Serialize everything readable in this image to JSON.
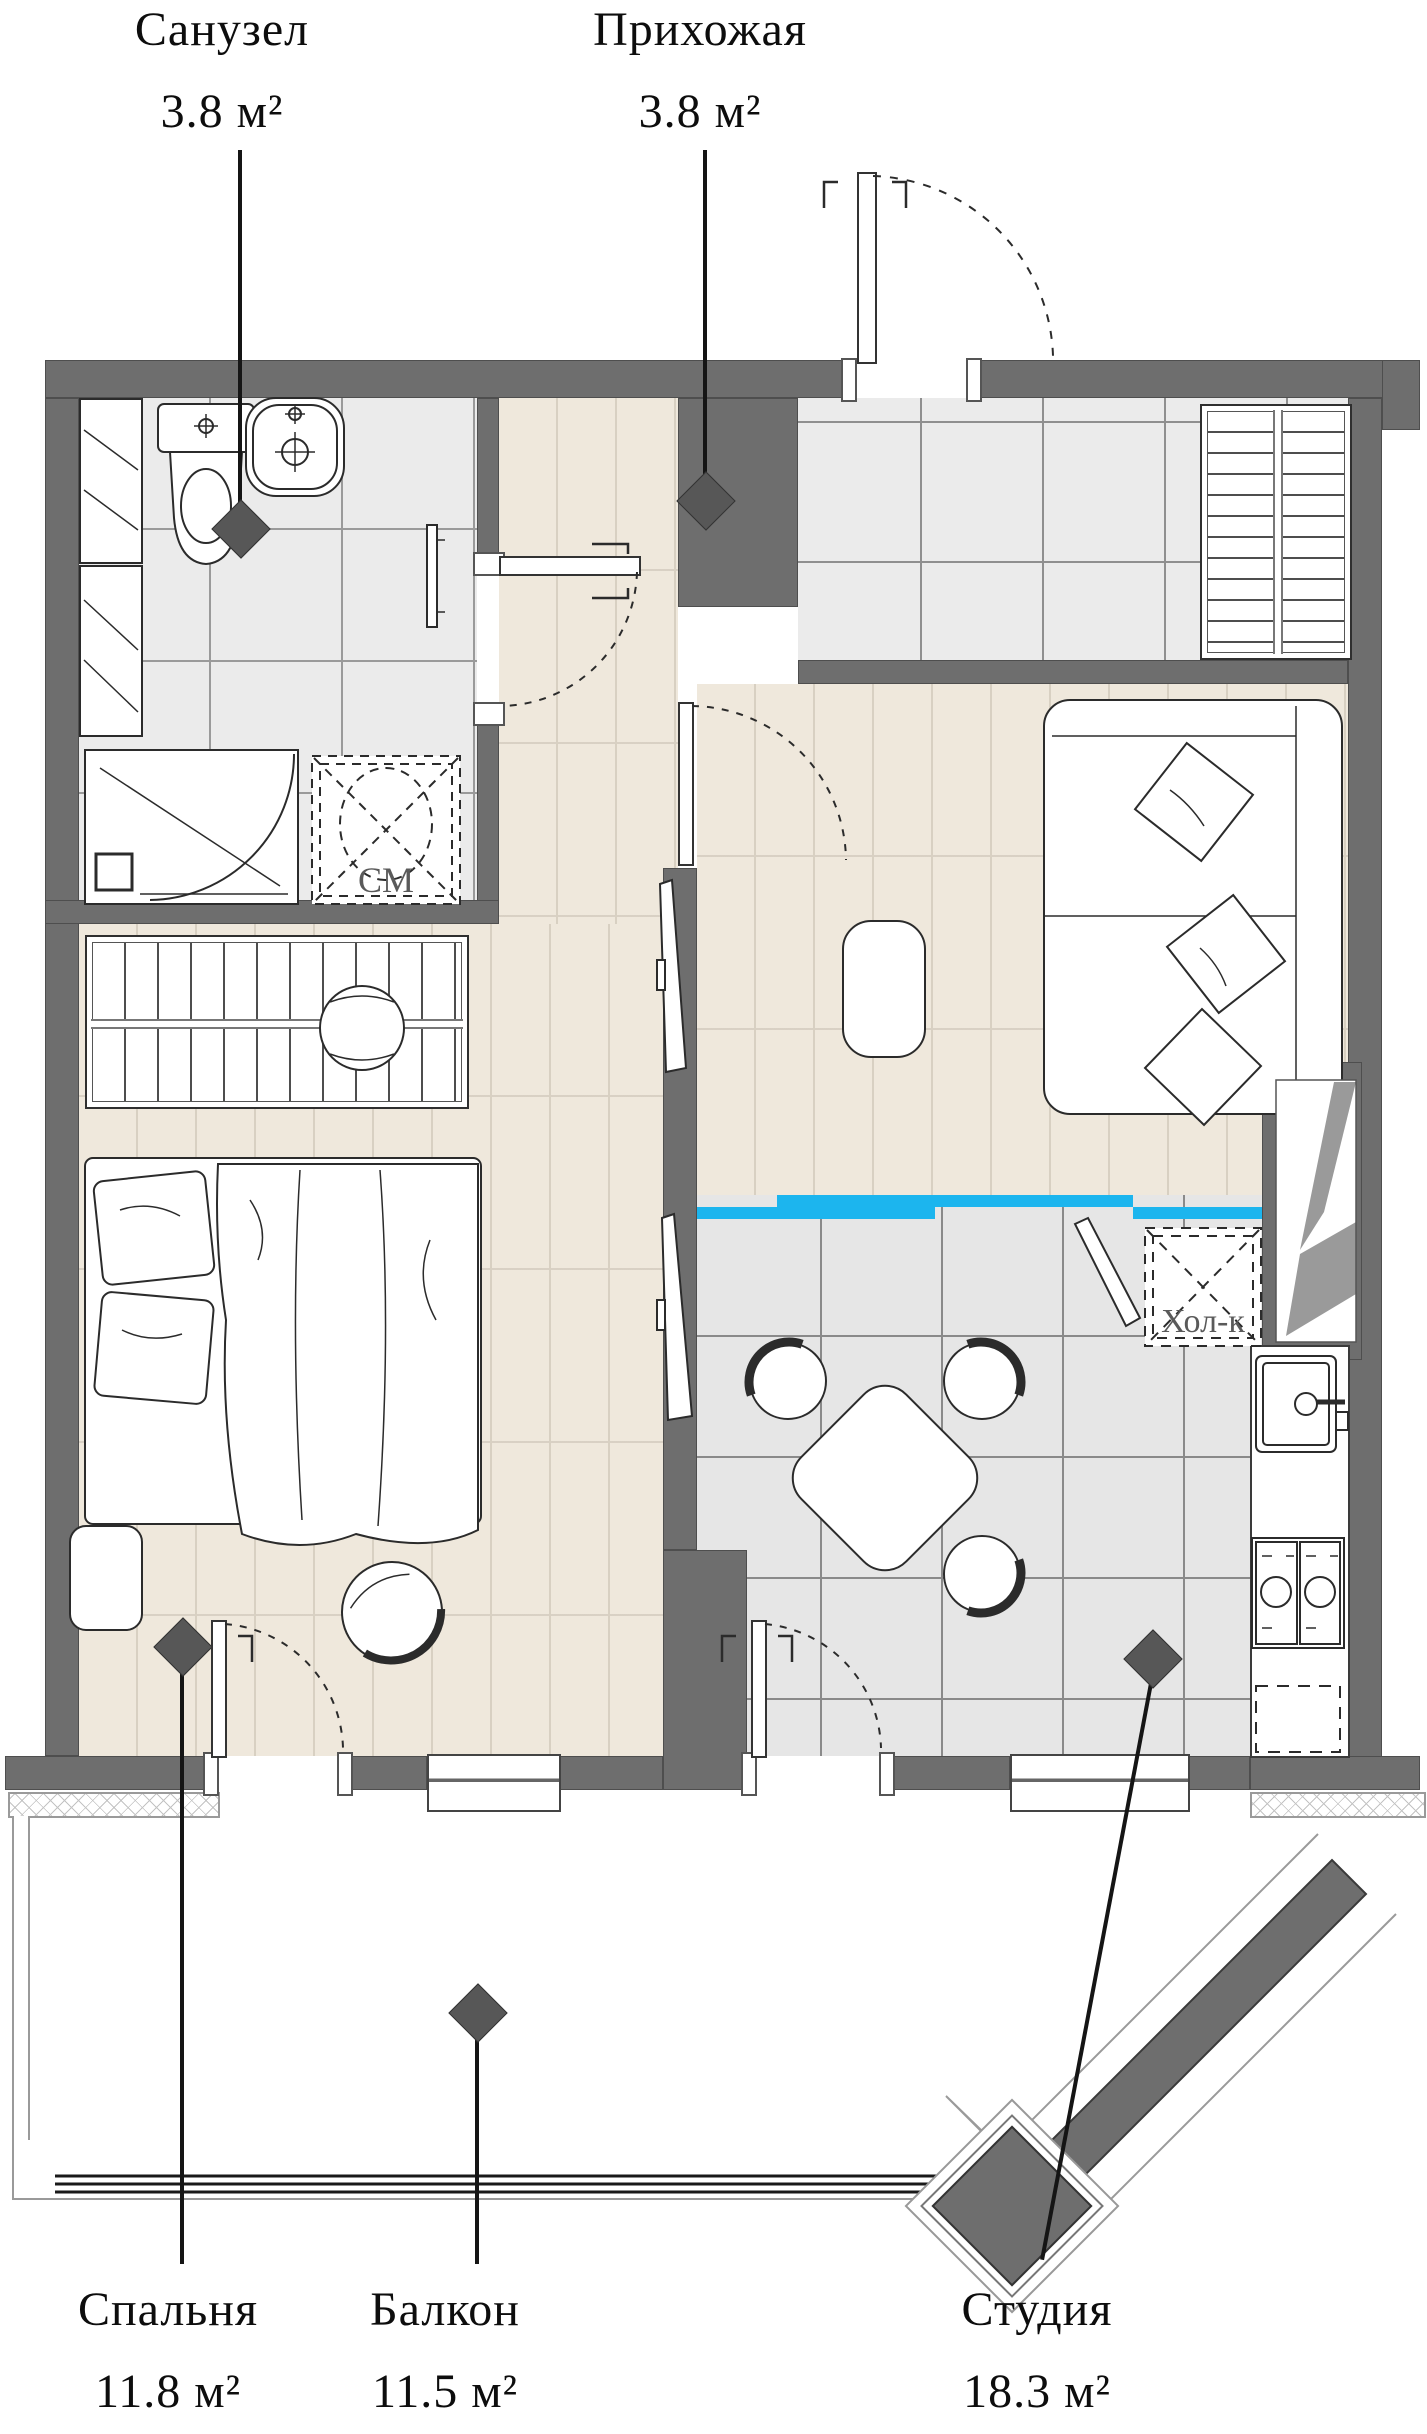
{
  "plan": {
    "title": "Apartment floor plan",
    "rooms": {
      "bathroom": {
        "name": "Санузел",
        "area": "3.8 м²"
      },
      "hallway": {
        "name": "Прихожая",
        "area": "3.8 м²"
      },
      "bedroom": {
        "name": "Спальня",
        "area": "11.8 м²"
      },
      "balcony": {
        "name": "Балкон",
        "area": "11.5 м²"
      },
      "studio": {
        "name": "Студия",
        "area": "18.3 м²"
      }
    },
    "appliance_labels": {
      "washing_machine": "СМ",
      "refrigerator": "Хол-к"
    },
    "colors": {
      "wall": "#6e6e6e",
      "bathroom_tile": "#ebebeb",
      "kitchen_tile": "#e6e6e6",
      "wood_floor": "#efe8dc",
      "floor_transition_accent": "#1cb5ee",
      "marker": "#575757",
      "label_text": "#0d0d0d"
    }
  }
}
